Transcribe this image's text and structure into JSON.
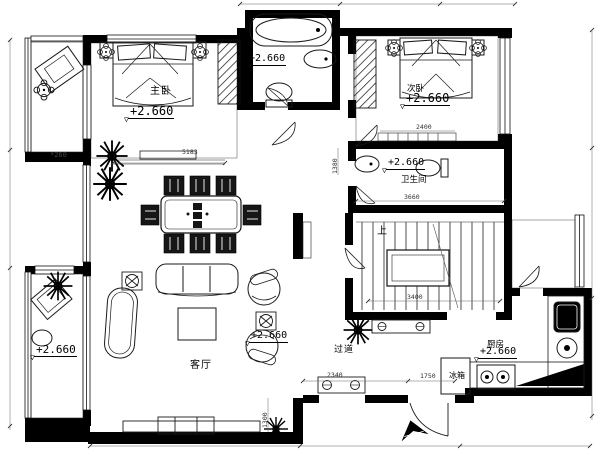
{
  "labels": {
    "master_bedroom": "主卧",
    "master_elev": "+2.660",
    "top_bath_elev": "+2.660",
    "second_bedroom": "次卧",
    "second_elev": "+2.660",
    "bathroom": "卫生间",
    "bathroom_elev": "+2.660",
    "living_room": "客厅",
    "living_elev": "+2.660",
    "corridor": "过道",
    "kitchen": "厨房",
    "kitchen_elev": "+2.660",
    "fridge": "冰箱",
    "stairs_up": "上",
    "balcony_elev": "+2.660",
    "balcony_note": "*260",
    "elevation_marker": "▽"
  },
  "dimensions": {
    "living_width": "5183",
    "bedroom2_width": "2400",
    "bathroom_width": "3660",
    "stairs_width": "3400",
    "console_width": "2340",
    "entry_width": "1750",
    "entry_side": "1300",
    "hall_side": "1380"
  }
}
